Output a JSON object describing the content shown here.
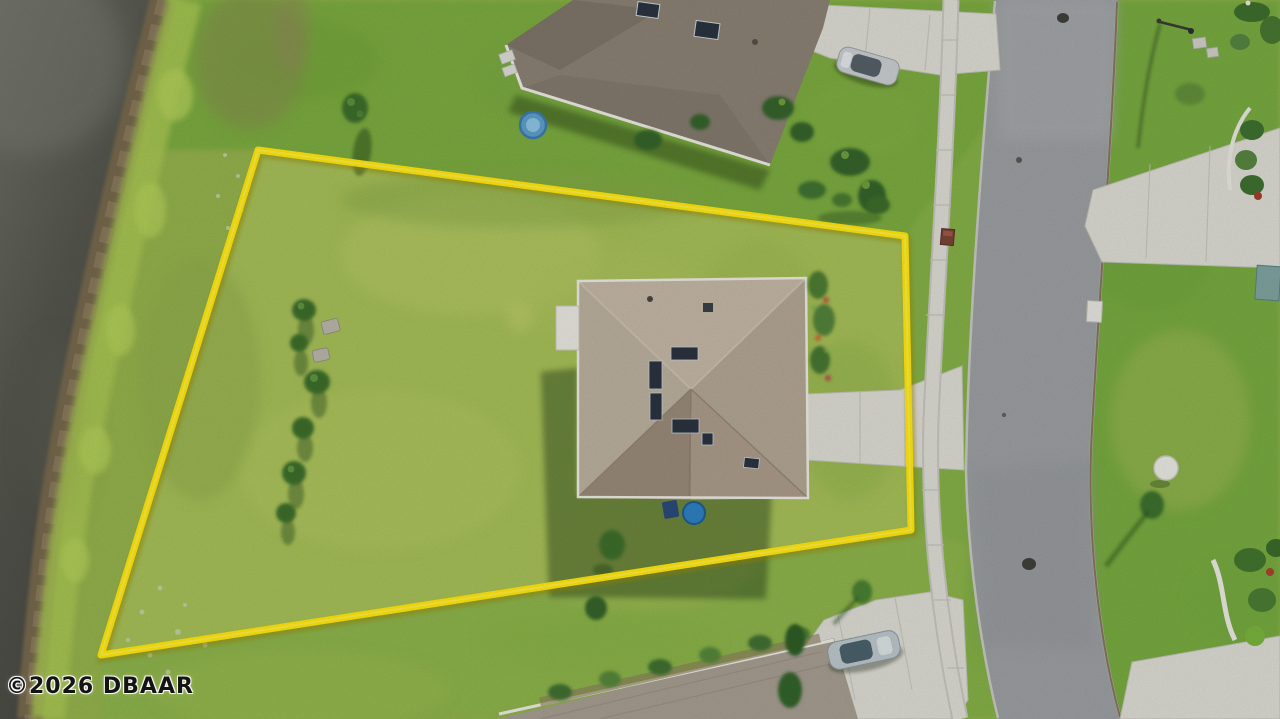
{
  "scene": {
    "description": "Aerial drone photo of a residential lot outlined in yellow: single-family home with tan hip roof and concrete driveway, pond shoreline at left, curved street with sidewalk at right, neighboring homes at top and bottom, parked cars, street lamp, manhole covers."
  },
  "watermark": {
    "text": "©2026 DBAAR"
  },
  "boundary": {
    "points": "258,150 905,236 911,530 101,655",
    "color": "#ffe70a"
  },
  "objects": {
    "pond": "pond water",
    "shoreline": "muddy shoreline",
    "lot": "grass lot inside boundary",
    "main_house": "tan hip-roof house",
    "north_house": "neighbor house (top)",
    "south_house": "neighbor house (bottom)",
    "road": "curved asphalt street",
    "sidewalk": "concrete sidewalk",
    "driveways": "concrete driveways",
    "car_north": "silver car parked (top driveway)",
    "car_south": "silver car parked (bottom driveway)",
    "street_lamp": "street lamp",
    "manholes": "manhole covers",
    "mailbox_red": "red mailbox at sidewalk",
    "mailbox_white": "white mailbox post",
    "kiddie_pool": "blue kiddie pool",
    "pool_equipment": "blue pool equipment",
    "tree_row": "row of young trees in lot",
    "patio_table": "white round table on far lawn"
  },
  "palette": {
    "grass_base": "#94b24c",
    "grass_north": "#7cab41",
    "grass_east": "#78aa3f",
    "grass_south": "#8db34c",
    "grass_lot": "#a6bf58",
    "water_dark": "#43443d",
    "water_light": "#6e7067",
    "mud_brown": "#76674e",
    "moss_green": "#a9c653",
    "road_gray": "#9c9fa2",
    "concrete": "#dcdbd3",
    "concrete_edge": "#c2c1b9",
    "curb_brown": "#7c6a50",
    "roof_main": "#b2a593",
    "roof_main_light": "#c3b7a5",
    "roof_main_dark": "#a2927f",
    "roof_north_house": "#8b8174",
    "roof_south_house": "#a69d90",
    "skylight_navy": "#2a3340",
    "fascia_white": "#eceae2",
    "boundary_yellow": "#ffe70a",
    "car_silver": "#c9cdd0",
    "glass_dark": "#49535c",
    "tree_green": "#3d6e2c",
    "bush_dark": "#35642a",
    "pool_blue": "#2f7fc0",
    "watermark_ink": "#141414"
  }
}
